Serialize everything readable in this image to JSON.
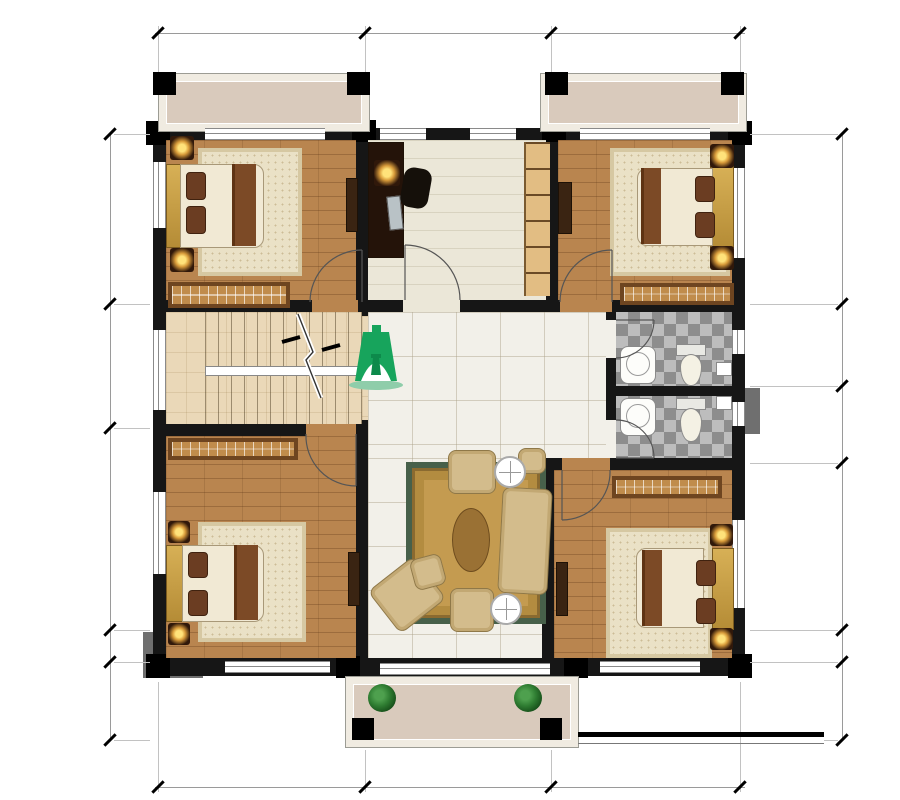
{
  "header": {
    "brand": "轩鼎建筑  712"
  },
  "logo": {
    "name_cn": "轩鼎别墅",
    "name_en": "XuanDing House",
    "brand_green": "#18a05c"
  },
  "rooms": {
    "balcony_top_left": "阳台",
    "balcony_top_right": "阳台",
    "balcony_bottom": "阳台",
    "bedroom_top_left": "卧室",
    "bedroom_top_right": "卧室",
    "bedroom_bottom_left": "卧室",
    "bedroom_bottom_right": "卧室",
    "study": "书房",
    "bathroom_upper": "卫生间",
    "bathroom_lower": "卫生间",
    "living_hall": "活动厅",
    "stair_direction": "下"
  },
  "dimensions": {
    "top": [
      "4000",
      "3600",
      "3700"
    ],
    "bottom": [
      "4000",
      "3600",
      "3700"
    ],
    "left": [
      "3300",
      "2400",
      "3900",
      "600",
      "1500"
    ],
    "right": [
      "3300",
      "1600",
      "1500",
      "3200",
      "600",
      "1500"
    ]
  },
  "title_block": {
    "title": "二层平面图",
    "scale": "1:100",
    "note": "注：本层建筑面积125.23m²"
  },
  "colors": {
    "wall": "#161616",
    "wood_floor": "#b9854f",
    "tile_floor": "#f2f0e9",
    "balcony_floor": "#d9cabc",
    "stair_floor": "#ead8b8",
    "rug": "#c49b50",
    "rug_border": "#47604a",
    "brand_green": "#18a05c"
  }
}
